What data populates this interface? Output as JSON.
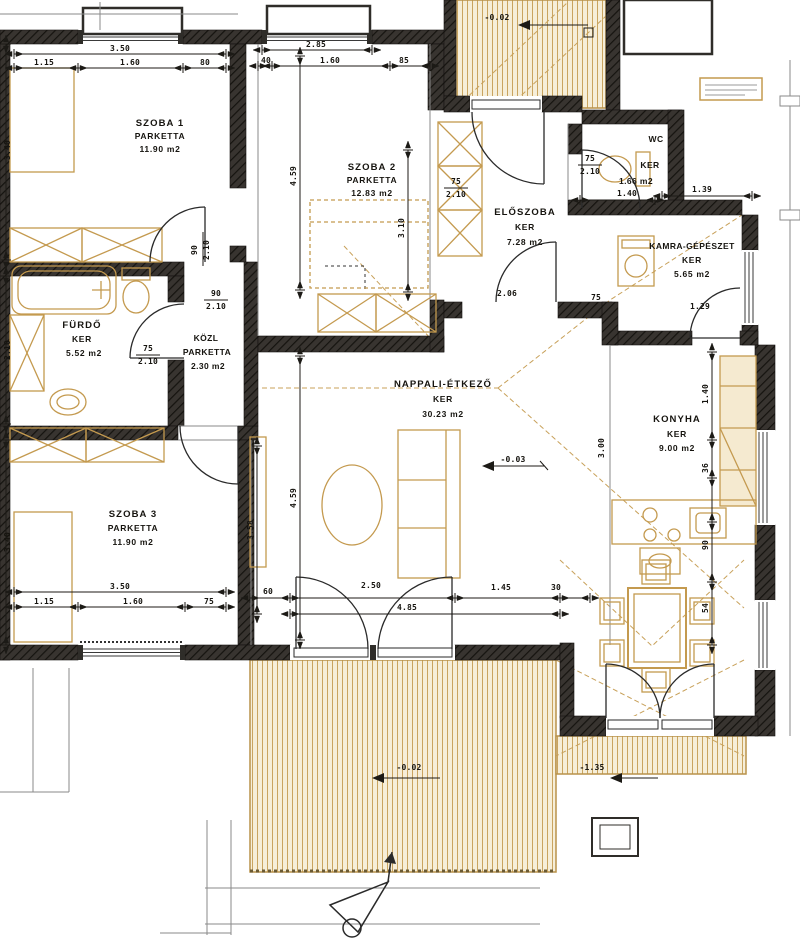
{
  "plan": {
    "type": "apartment-floor-plan",
    "colors": {
      "wall": "#33302b",
      "accent": "#c49a4f",
      "deck": "#f6eed8",
      "line": "#1c1a16"
    }
  },
  "rooms": [
    {
      "id": "szoba1",
      "name": "SZOBA 1",
      "floor": "PARKETTA",
      "area": "11.90 m2"
    },
    {
      "id": "szoba2",
      "name": "SZOBA 2",
      "floor": "PARKETTA",
      "area": "12.83 m2"
    },
    {
      "id": "eloszoba",
      "name": "ELŐSZOBA",
      "floor": "KER",
      "area": "7.28 m2"
    },
    {
      "id": "wc",
      "name": "WC",
      "floor": "KER",
      "area": "1.66 m2"
    },
    {
      "id": "kamra",
      "name": "KAMRA-GÉPÉSZET",
      "floor": "KER",
      "area": "5.65 m2"
    },
    {
      "id": "furdo",
      "name": "FÜRDŐ",
      "floor": "KER",
      "area": "5.52 m2"
    },
    {
      "id": "kozl",
      "name": "KÖZL",
      "floor": "PARKETTA",
      "area": "2.30 m2"
    },
    {
      "id": "nappali",
      "name": "NAPPALI-ÉTKEZŐ",
      "floor": "KER",
      "area": "30.23 m2"
    },
    {
      "id": "konyha",
      "name": "KONYHA",
      "floor": "KER",
      "area": "9.00 m2"
    },
    {
      "id": "szoba3",
      "name": "SZOBA 3",
      "floor": "PARKETTA",
      "area": "11.90 m2"
    }
  ],
  "dimensions": [
    {
      "t": "3.50",
      "x": 120,
      "y": 51
    },
    {
      "t": "1.15",
      "x": 44,
      "y": 65
    },
    {
      "t": "1.60",
      "x": 130,
      "y": 65
    },
    {
      "t": "80",
      "x": 205,
      "y": 65
    },
    {
      "t": "2.85",
      "x": 316,
      "y": 47
    },
    {
      "t": "40",
      "x": 266,
      "y": 63
    },
    {
      "t": "1.60",
      "x": 330,
      "y": 63
    },
    {
      "t": "85",
      "x": 404,
      "y": 63
    },
    {
      "t": "3.40",
      "x": 10,
      "y": 150,
      "r": 1
    },
    {
      "t": "2.10",
      "x": 10,
      "y": 350,
      "r": 1
    },
    {
      "t": "3.40",
      "x": 10,
      "y": 542,
      "r": 1
    },
    {
      "t": "4.59",
      "x": 296,
      "y": 176,
      "r": 1
    },
    {
      "t": "3.10",
      "x": 404,
      "y": 228,
      "r": 1
    },
    {
      "t": "4.59",
      "x": 296,
      "y": 498,
      "r": 1
    },
    {
      "t": "3.58",
      "x": 253,
      "y": 530,
      "r": 1
    },
    {
      "t": "3.00",
      "x": 604,
      "y": 448,
      "r": 1
    },
    {
      "t": "1.40",
      "x": 708,
      "y": 394,
      "r": 1
    },
    {
      "t": "36",
      "x": 708,
      "y": 468,
      "r": 1
    },
    {
      "t": "90",
      "x": 708,
      "y": 545,
      "r": 1
    },
    {
      "t": "54",
      "x": 708,
      "y": 608,
      "r": 1
    },
    {
      "t": "90",
      "x": 197,
      "y": 250,
      "r": 1
    },
    {
      "t": "2.10",
      "x": 209,
      "y": 250,
      "r": 1
    },
    {
      "t": "90",
      "x": 216,
      "y": 296
    },
    {
      "t": "2.10",
      "x": 216,
      "y": 309
    },
    {
      "t": "75",
      "x": 148,
      "y": 351
    },
    {
      "t": "2.10",
      "x": 148,
      "y": 364
    },
    {
      "t": "75",
      "x": 456,
      "y": 184
    },
    {
      "t": "2.10",
      "x": 456,
      "y": 197
    },
    {
      "t": "75",
      "x": 590,
      "y": 161
    },
    {
      "t": "2.10",
      "x": 590,
      "y": 174
    },
    {
      "t": "1.40",
      "x": 627,
      "y": 196
    },
    {
      "t": "1.39",
      "x": 702,
      "y": 192
    },
    {
      "t": "2.06",
      "x": 507,
      "y": 296
    },
    {
      "t": "75",
      "x": 596,
      "y": 300
    },
    {
      "t": "1.29",
      "x": 700,
      "y": 309
    },
    {
      "t": "3.50",
      "x": 120,
      "y": 589
    },
    {
      "t": "1.15",
      "x": 44,
      "y": 604
    },
    {
      "t": "1.60",
      "x": 133,
      "y": 604
    },
    {
      "t": "75",
      "x": 209,
      "y": 604
    },
    {
      "t": "60",
      "x": 268,
      "y": 594
    },
    {
      "t": "2.50",
      "x": 371,
      "y": 588
    },
    {
      "t": "1.45",
      "x": 501,
      "y": 590
    },
    {
      "t": "30",
      "x": 556,
      "y": 590
    },
    {
      "t": "4.85",
      "x": 407,
      "y": 610
    },
    {
      "t": "-0.02",
      "x": 497,
      "y": 20
    },
    {
      "t": "-0.03",
      "x": 513,
      "y": 462
    },
    {
      "t": "-0.02",
      "x": 409,
      "y": 770
    },
    {
      "t": "-1.35",
      "x": 592,
      "y": 770
    }
  ]
}
